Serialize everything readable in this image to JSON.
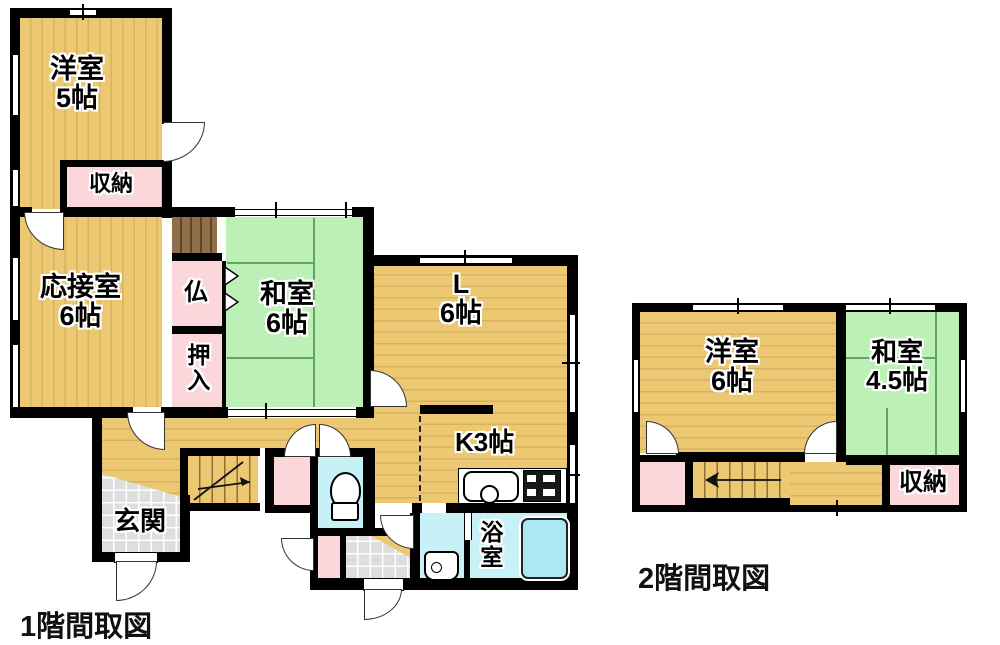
{
  "document_title": "間取図",
  "floor1": {
    "title": "1階間取図",
    "rooms": {
      "youshitsu": {
        "name": "洋室",
        "size": "5帖"
      },
      "shuunou": {
        "label": "収納"
      },
      "ousetsushitsu": {
        "name": "応接室",
        "size": "6帖"
      },
      "butsuma": {
        "label": "仏"
      },
      "oshiire": {
        "label": "押入"
      },
      "washitsu": {
        "name": "和室",
        "size": "6帖"
      },
      "living": {
        "name": "L",
        "size": "6帖"
      },
      "kitchen": {
        "label": "K3帖"
      },
      "genkan": {
        "label": "玄関"
      },
      "bathroom": {
        "label": "浴室"
      }
    }
  },
  "floor2": {
    "title": "2階間取図",
    "rooms": {
      "youshitsu": {
        "name": "洋室",
        "size": "6帖"
      },
      "washitsu": {
        "name": "和室",
        "size": "4.5帖"
      },
      "shuunou": {
        "label": "収納"
      }
    }
  },
  "colors": {
    "wall": "#000000",
    "wood_floor": "#ecc873",
    "tatami": "#bdf0b6",
    "tatami_line": "#5ea75e",
    "closet_pink": "#fbd7dc",
    "wet_area_cyan": "#c6f1f7",
    "bathtub": "#ace8f3",
    "tile_gray": "#dedede",
    "stair_brown": "#8f6f47"
  }
}
